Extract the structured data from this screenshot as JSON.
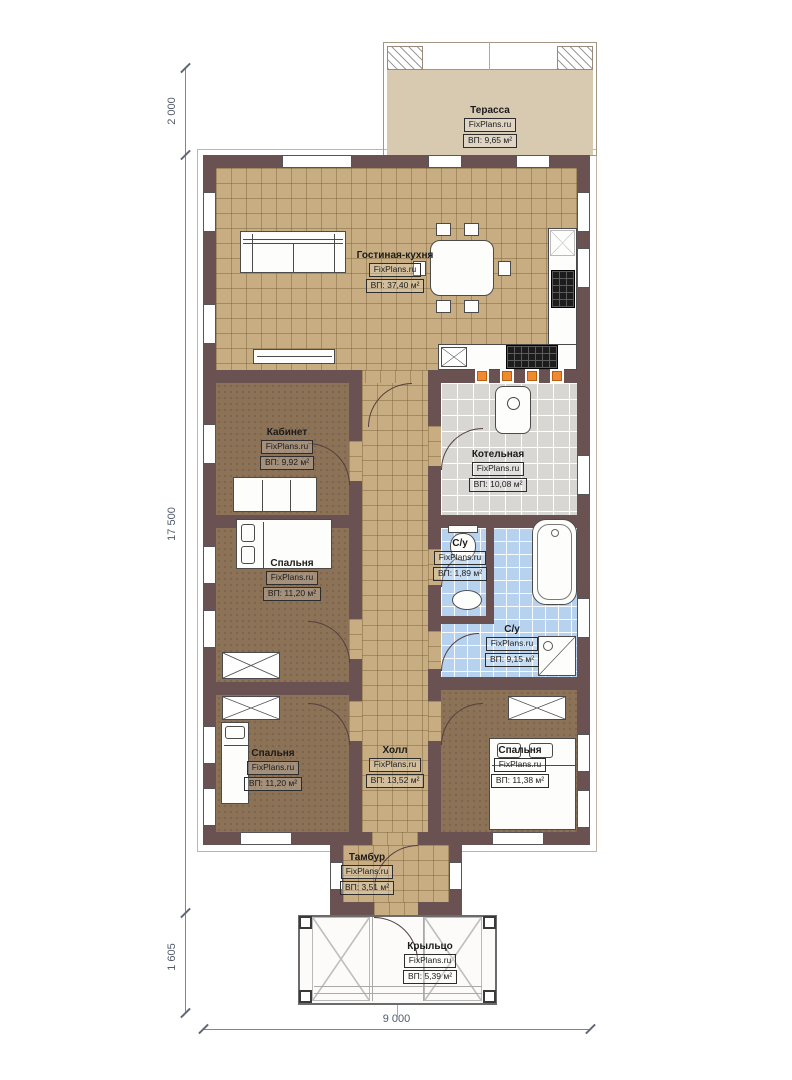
{
  "plan": {
    "title": "Floor plan",
    "brand": "FixPlans.ru"
  },
  "brand": "FixPlans.ru",
  "dims": {
    "v_top": "2 000",
    "v_main": "17 500",
    "v_bottom": "1 605",
    "h_width": "9 000"
  },
  "rooms": [
    {
      "name": "Терасса",
      "area": "ВП: 9,65 м²"
    },
    {
      "name": "Гостиная-кухня",
      "area": "ВП: 37,40 м²"
    },
    {
      "name": "Кабинет",
      "area": "ВП: 9,92 м²"
    },
    {
      "name": "Котельная",
      "area": "ВП: 10,08 м²"
    },
    {
      "name": "С/у",
      "area": "ВП: 1,89 м²"
    },
    {
      "name": "С/у",
      "area": "ВП: 9,15 м²"
    },
    {
      "name": "Спальня",
      "area": "ВП: 11,20 м²"
    },
    {
      "name": "Спальня",
      "area": "ВП: 11,20 м²"
    },
    {
      "name": "Холл",
      "area": "ВП: 13,52 м²"
    },
    {
      "name": "Спальня",
      "area": "ВП: 11,38 м²"
    },
    {
      "name": "Тамбур",
      "area": "ВП: 3,51 м²"
    },
    {
      "name": "Крыльцо",
      "area": "ВП: 5,39 м²"
    }
  ],
  "colors": {
    "wall": "#6a5253",
    "floor_tan": "#c8ad82",
    "floor_brown": "#8c7256",
    "tile_blue": "#b7d2ef",
    "tile_gray": "#d8d7d4",
    "terrace": "#d8c9b1",
    "heater_orange": "#ef8a2e"
  }
}
